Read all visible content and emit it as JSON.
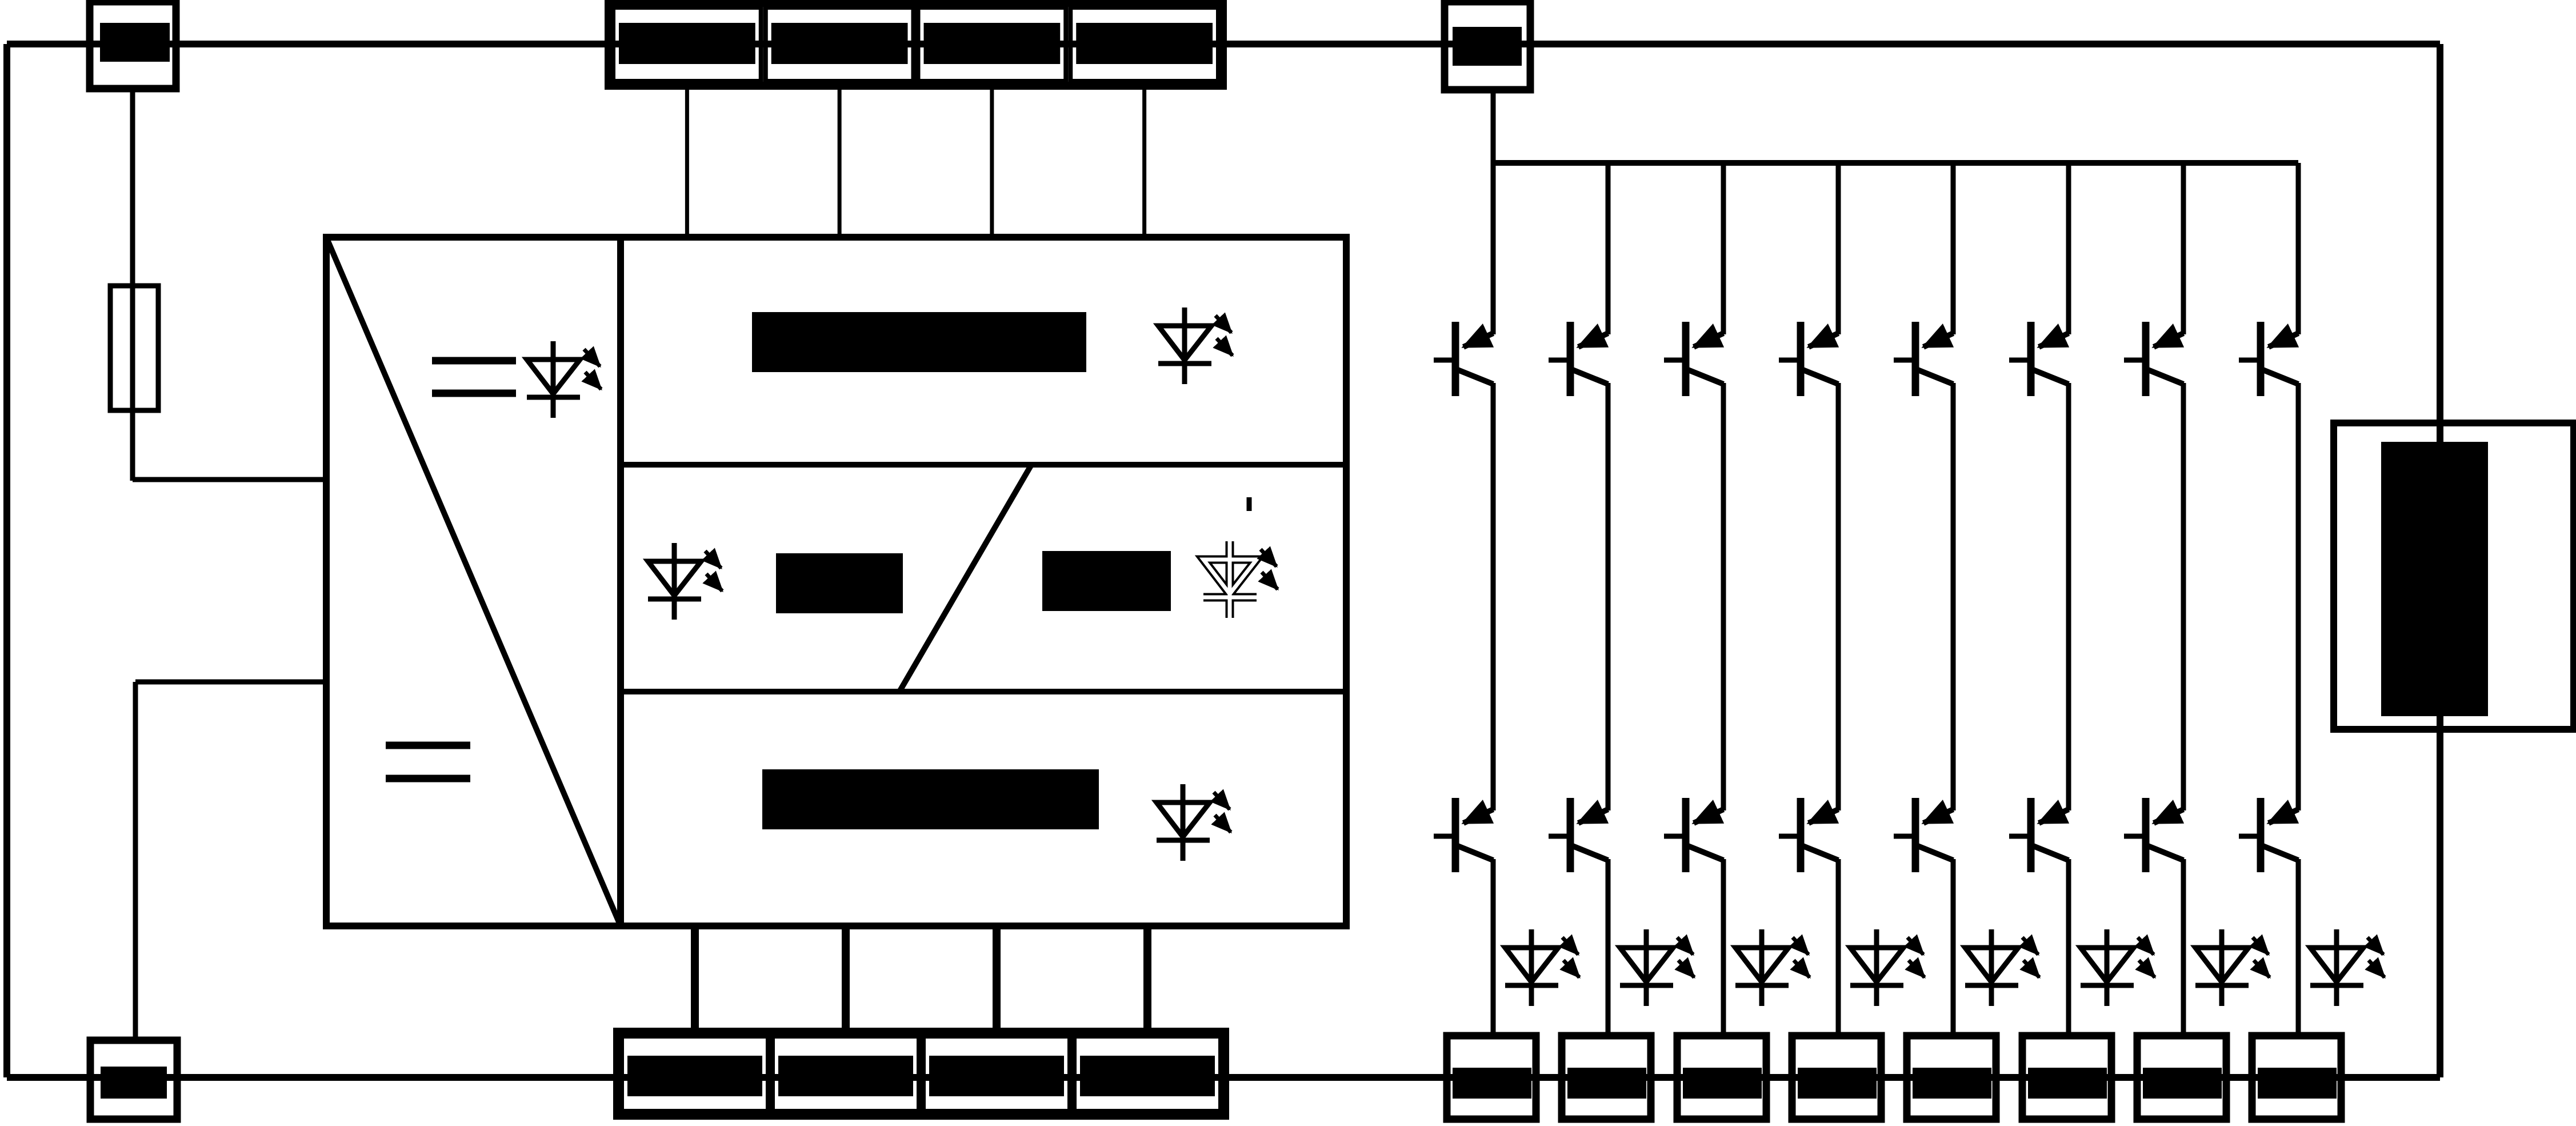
{
  "figure": {
    "kind": "circuit-schematic",
    "description": "Monochrome wiring schematic with all part labels redacted by solid black bars",
    "text_visible": false
  },
  "colors": {
    "background": "#ffffff",
    "line": "#000000",
    "redaction": "#000000",
    "ghost_fill": "#ffffff"
  },
  "left_section": {
    "top_terminal_box": {
      "label_redacted": true
    },
    "fuse_symbol": {
      "present": true
    },
    "converter_block": {
      "symbol": "rectangle-with-diagonal",
      "upper_marking": "=",
      "lower_marking": "=",
      "led_symbol": "solid"
    },
    "bottom_terminal_box": {
      "label_redacted": true
    }
  },
  "center_block": {
    "bands": [
      {
        "redacted_bars": 1,
        "led_symbols": [
          "solid"
        ]
      },
      {
        "redacted_bars": 2,
        "led_symbols": [
          "solid",
          "ghost-outline"
        ],
        "divider": "slash",
        "tick_mark": true
      },
      {
        "redacted_bars": 1,
        "led_symbols": [
          "solid"
        ]
      }
    ]
  },
  "top_terminal_strip": {
    "count": 4,
    "labels_redacted": true
  },
  "bottom_terminal_strip": {
    "count": 4,
    "labels_redacted": true
  },
  "gate_feed_terminal_box": {
    "label_redacted": true
  },
  "output_columns": {
    "count": 8,
    "per_column": [
      "upper-transistor",
      "lower-transistor",
      "led-symbol",
      "terminal-box"
    ],
    "labels_redacted": true
  },
  "right_connector_box": {
    "label_redacted": true,
    "fill_bar": true
  }
}
